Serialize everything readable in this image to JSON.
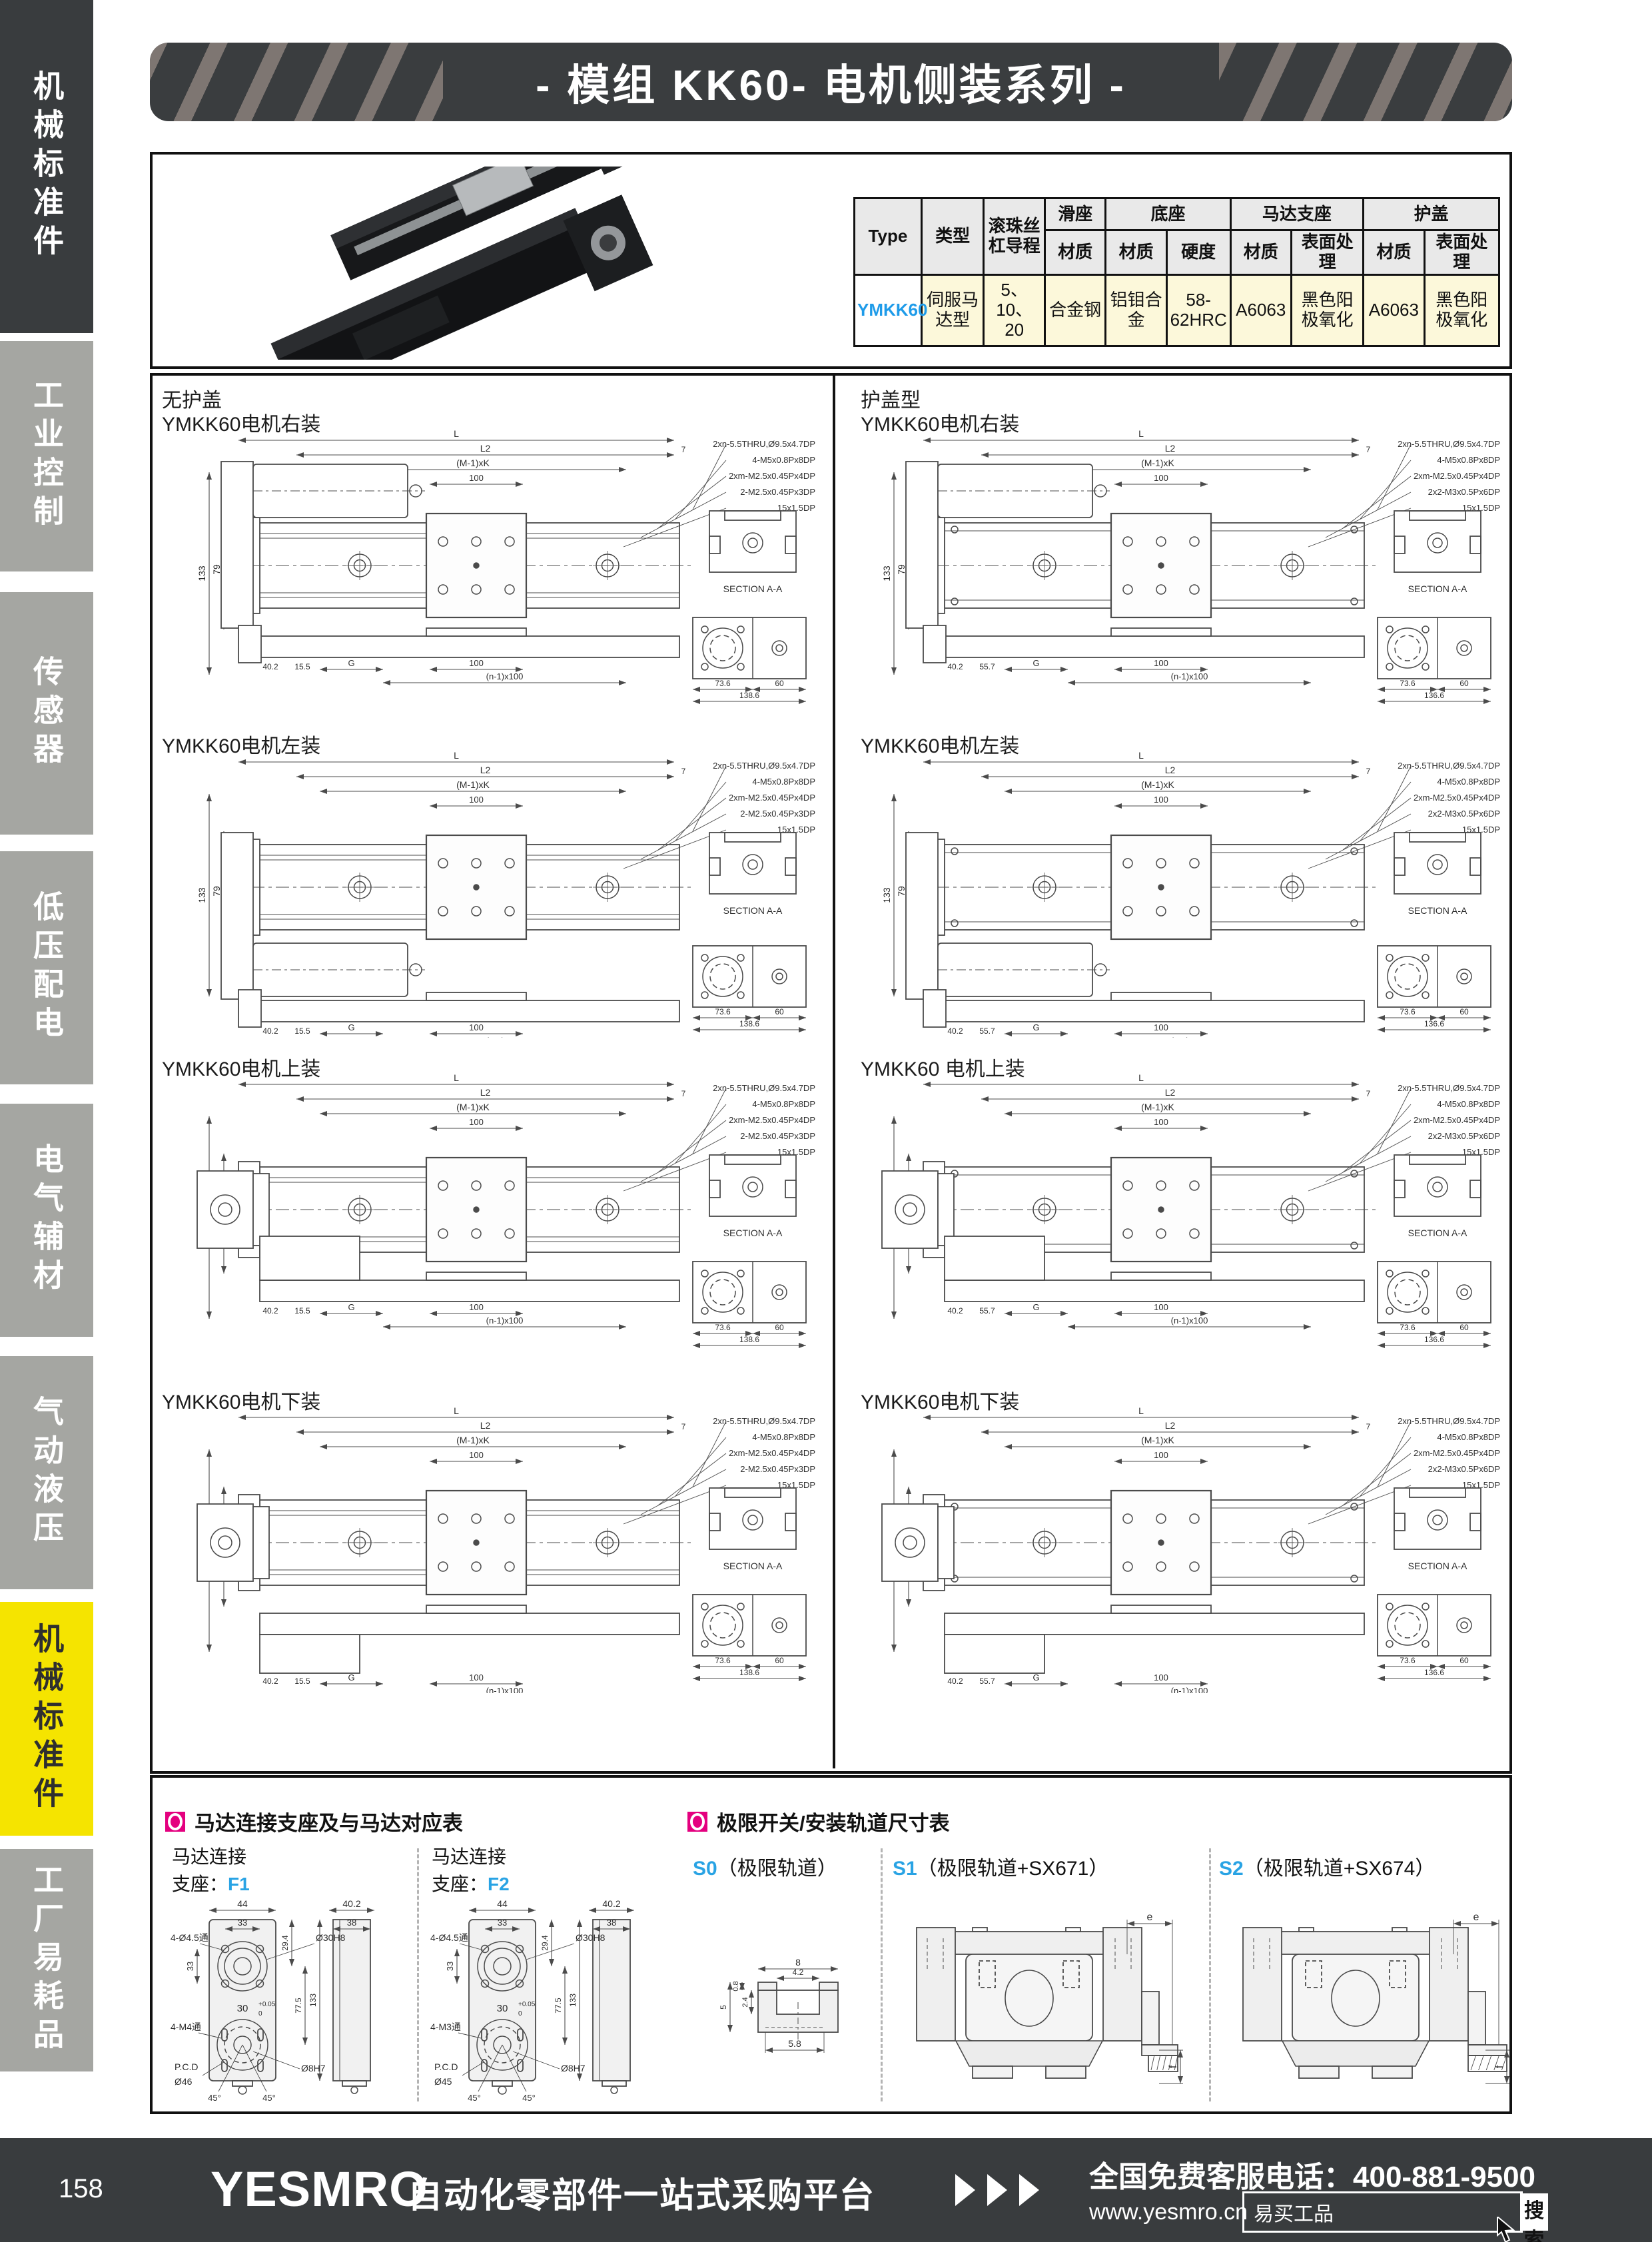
{
  "header": {
    "title": "- 模组 KK60- 电机侧装系列 -"
  },
  "sidebar": {
    "items": [
      {
        "label": "机械标准件",
        "variant": "dark"
      },
      {
        "label": "工业控制",
        "variant": "gray"
      },
      {
        "label": "传感器",
        "variant": "gray"
      },
      {
        "label": "低压配电",
        "variant": "gray"
      },
      {
        "label": "电气辅材",
        "variant": "gray"
      },
      {
        "label": "气动液压",
        "variant": "gray"
      },
      {
        "label": "机械标准件",
        "variant": "yellow"
      },
      {
        "label": "工厂易耗品",
        "variant": "gray"
      }
    ]
  },
  "spec_table": {
    "h_type": "Type",
    "h_kind": "类型",
    "h_lead": "滚珠丝杠导程",
    "groups": [
      {
        "label": "滑座",
        "cols": [
          "材质"
        ]
      },
      {
        "label": "底座",
        "cols": [
          "材质",
          "硬度"
        ]
      },
      {
        "label": "马达支座",
        "cols": [
          "材质",
          "表面处理"
        ]
      },
      {
        "label": "护盖",
        "cols": [
          "材质",
          "表面处理"
        ]
      }
    ],
    "row": {
      "type": "YMKK60",
      "values": [
        "伺服马达型",
        "5、10、20",
        "合金钢",
        "铝钼合金",
        "58-62HRC",
        "A6063",
        "黑色阳极氧化",
        "A6063",
        "黑色阳极氧化"
      ]
    }
  },
  "drawings": {
    "left": {
      "heading": "无护盖",
      "annot": {
        "dim_l": "L",
        "dim_l2": "L2",
        "dim_mk": "(M-1)xK",
        "dim_100": "100",
        "dim_g": "G",
        "dim_n100": "(n-1)x100",
        "dim_133": "133",
        "dim_79": "79",
        "dim_402": "40.2",
        "dim_155": "15.5",
        "dim_7": "7",
        "sec": "SECTION A-A",
        "end1": "73.6",
        "end2": "60",
        "end3": "138.6",
        "notes": [
          "2xn-5.5THRU,Ø9.5x4.7DP",
          "4-M5x0.8Px8DP",
          "2xm-M2.5x0.45Px4DP",
          "2-M2.5x0.45Px3DP",
          "15x1.5DP"
        ]
      },
      "sections": [
        {
          "label": "YMKK60电机右装",
          "motor": "right"
        },
        {
          "label": "YMKK60电机左装",
          "motor": "left"
        },
        {
          "label": "YMKK60电机上装",
          "motor": "top"
        },
        {
          "label": "YMKK60电机下装",
          "motor": "bottom"
        }
      ]
    },
    "right": {
      "heading": "护盖型",
      "annot": {
        "dim_l": "L",
        "dim_l2": "L2",
        "dim_mk": "(M-1)xK",
        "dim_100": "100",
        "dim_g": "G",
        "dim_n100": "(n-1)x100",
        "dim_133": "133",
        "dim_79": "79",
        "dim_402": "40.2",
        "dim_155": "55.7",
        "dim_7": "7",
        "sec": "SECTION A-A",
        "end1": "73.6",
        "end2": "60",
        "end3": "136.6",
        "notes": [
          "2xn-5.5THRU,Ø9.5x4.7DP",
          "4-M5x0.8Px8DP",
          "2xm-M2.5x0.45Px4DP",
          "2x2-M3x0.5Px6DP",
          "15x1.5DP"
        ]
      },
      "sections": [
        {
          "label": "YMKK60电机右装",
          "motor": "right"
        },
        {
          "label": "YMKK60电机左装",
          "motor": "left"
        },
        {
          "label": "YMKK60 电机上装",
          "motor": "top"
        },
        {
          "label": "YMKK60电机下装",
          "motor": "bottom"
        }
      ]
    }
  },
  "motor_section": {
    "title": "马达连接支座及与马达对应表",
    "label_line1": "马达连接",
    "label_line2": "支座：",
    "brackets": [
      {
        "code": "F1",
        "dims": {
          "w": "44",
          "inner": "33",
          "holes": "4-Ø4.5通",
          "bore": "Ø30H8",
          "side_w": "40.2",
          "side_in": "38",
          "left": "33",
          "right": "29.4",
          "mid": "30",
          "mid_tol": "+0.05",
          "mid_tol0": "0",
          "v1": "77.5",
          "v2": "133",
          "thread": "4-M4通",
          "pcd": "P.C.D",
          "pcd_d": "Ø46",
          "shaft": "Ø8H7",
          "a1": "45°",
          "a2": "45°"
        }
      },
      {
        "code": "F2",
        "dims": {
          "w": "44",
          "inner": "33",
          "holes": "4-Ø4.5通",
          "bore": "Ø30H8",
          "side_w": "40.2",
          "side_in": "38",
          "left": "33",
          "right": "29.4",
          "mid": "30",
          "mid_tol": "+0.05",
          "mid_tol0": "0",
          "v1": "77.5",
          "v2": "133",
          "thread": "4-M3通",
          "pcd": "P.C.D",
          "pcd_d": "Ø45",
          "shaft": "Ø8H7",
          "a1": "45°",
          "a2": "45°"
        }
      }
    ]
  },
  "limit_section": {
    "title": "极限开关/安装轨道尺寸表",
    "variants": [
      {
        "code": "S0",
        "name": "（极限轨道）",
        "dims": {
          "top": "8",
          "opening": "4.2",
          "lip": "0.8",
          "depth": "2.4",
          "height": "5",
          "bottom": "5.8"
        }
      },
      {
        "code": "S1",
        "name": "（极限轨道+SX671）",
        "dims": {
          "e": "e",
          "f": "f"
        }
      },
      {
        "code": "S2",
        "name": "（极限轨道+SX674）",
        "dims": {
          "e": "e",
          "f": "f"
        }
      }
    ]
  },
  "footer": {
    "page": "158",
    "logo": "YESMRO",
    "tagline": "自动化零部件一站式采购平台",
    "phone_label": "全国免费客服电话：",
    "phone": "400-881-9500",
    "website": "www.yesmro.cn",
    "search_value": "易买工品",
    "search_button": "搜索"
  }
}
